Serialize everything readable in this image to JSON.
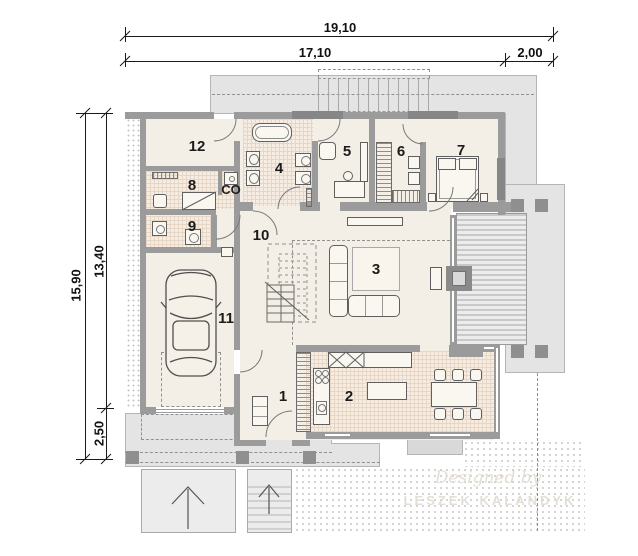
{
  "dimensions": {
    "total_width": "19,10",
    "main_width": "17,10",
    "terrace_width": "2,00",
    "total_depth": "15,90",
    "main_depth": "13,40",
    "porch_depth": "2,50"
  },
  "rooms": {
    "r1": "1",
    "r2": "2",
    "r3": "3",
    "r4": "4",
    "r5": "5",
    "r6": "6",
    "r7": "7",
    "r8": "8",
    "r9": "9",
    "r10": "10",
    "r11": "11",
    "r12": "12",
    "co": "CO"
  },
  "watermark": {
    "line1": "Designed by",
    "line2": "LESZEK KALANDYK"
  },
  "colors": {
    "wall": "#9b9b9b",
    "floor": "#f4efe6",
    "tile": "#f7ece1",
    "tile_grid": "#e6d6c6",
    "overhang": "#e4e4e4",
    "pillar": "#8f8f8f",
    "furn": "#faf7f0",
    "wm": "#e4dfd6",
    "dim_text": "#111111"
  }
}
